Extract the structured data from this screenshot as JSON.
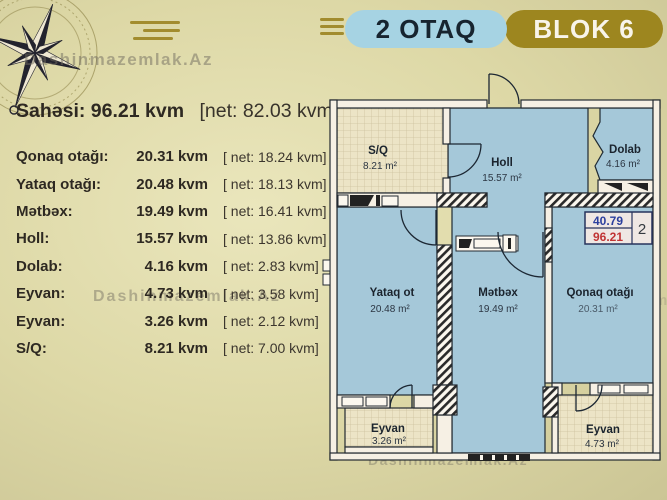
{
  "header": {
    "room_type": "2 OTAQ",
    "block": "BLOK 6"
  },
  "watermark": "Dashinmazemlak.Az",
  "summary": {
    "label": "Sahəsi:",
    "value": "96.21 kvm",
    "net": "[net: 82.03 kvm]"
  },
  "table": {
    "rows": [
      {
        "label": "Qonaq otağı:",
        "value": "20.31 kvm",
        "net": "[ net:  18.24 kvm]"
      },
      {
        "label": "Yataq otağı:",
        "value": "20.48 kvm",
        "net": "[ net:  18.13 kvm]"
      },
      {
        "label": "Mətbəx:",
        "value": "19.49 kvm",
        "net": "[ net:  16.41 kvm]"
      },
      {
        "label": "Holl:",
        "value": "15.57 kvm",
        "net": "[ net:  13.86 kvm]"
      },
      {
        "label": "Dolab:",
        "value": "4.16 kvm",
        "net": "[ net:   2.83 kvm]"
      },
      {
        "label": "Eyvan:",
        "value": "4.73 kvm",
        "net": "[ net:   3.58 kvm]"
      },
      {
        "label": "Eyvan:",
        "value": "3.26 kvm",
        "net": "[ net:   2.12 kvm]"
      },
      {
        "label": "S/Q:",
        "value": "8.21 kvm",
        "net": "[ net:   7.00 kvm]"
      }
    ]
  },
  "floorplan": {
    "rooms": [
      {
        "name": "S/Q",
        "area": "8.21 m²"
      },
      {
        "name": "Holl",
        "area": "15.57 m²"
      },
      {
        "name": "Dolab",
        "area": "4.16 m²"
      },
      {
        "name": "Yataq ot",
        "area": "20.48 m²"
      },
      {
        "name": "Mətbəx",
        "area": "19.49 m²"
      },
      {
        "name": "Qonaq otağı",
        "area": "20.31 m²"
      },
      {
        "name": "Eyvan",
        "area": "3.26 m²"
      },
      {
        "name": "Eyvan",
        "area": "4.73 m²"
      }
    ],
    "unit_badge": {
      "net_area": "40.79",
      "gross_area": "96.21",
      "unit_number": "2"
    }
  },
  "colors": {
    "page_bg": "#ddd8a6",
    "pill_blue": "#a6d3e3",
    "pill_gold": "#9d861f",
    "room_fill": "#a5c8d9",
    "tile_fill": "#ece4c6",
    "badge_blue": "#2b3f9e",
    "badge_red": "#c03434"
  }
}
